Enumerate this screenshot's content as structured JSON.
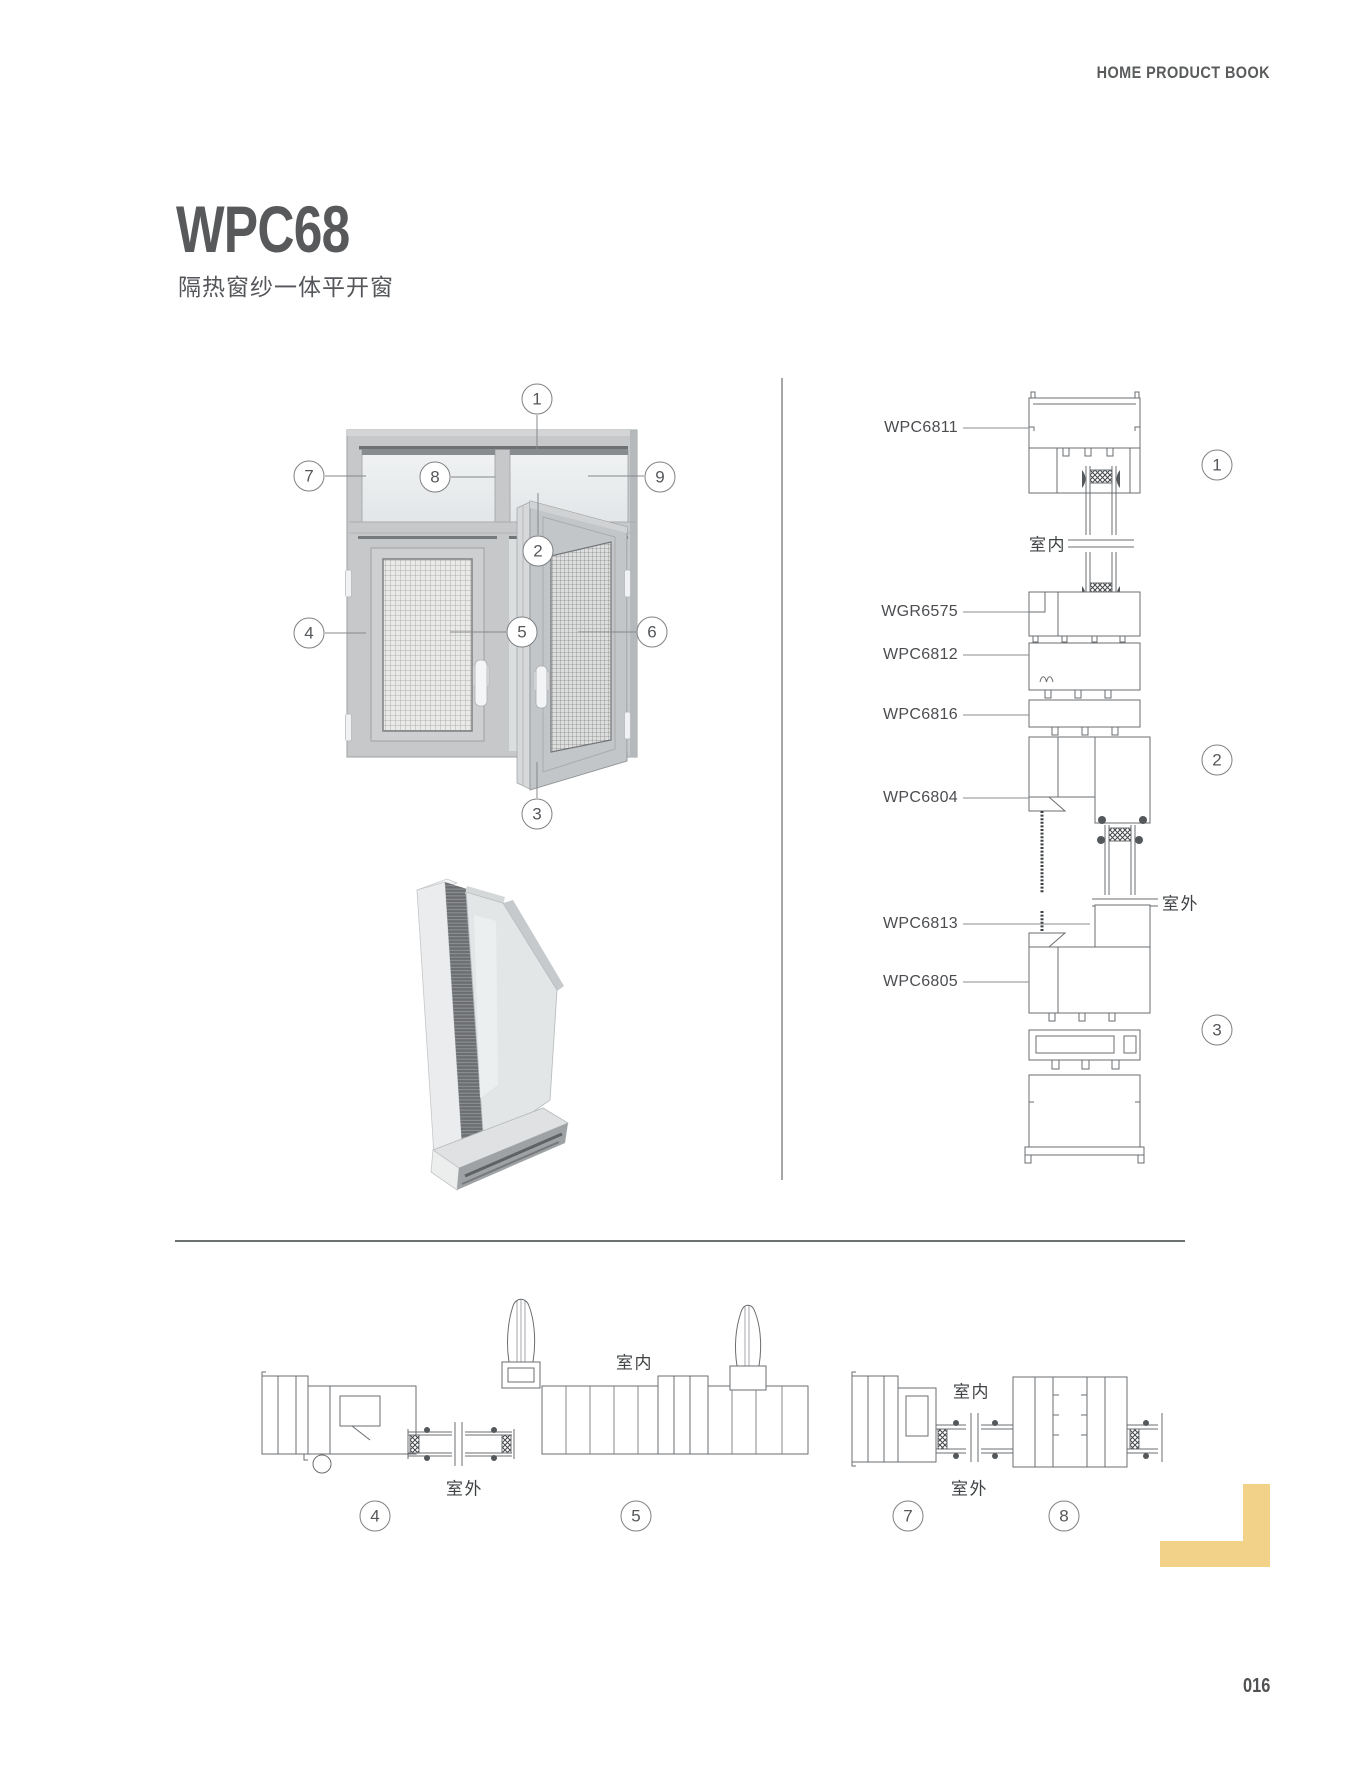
{
  "header": {
    "brand": "HOME PRODUCT BOOK"
  },
  "product": {
    "code": "WPC68",
    "name": "隔热窗纱一体平开窗"
  },
  "sides": {
    "indoor": "室内",
    "outdoor": "室外"
  },
  "callouts": {
    "c1": "1",
    "c2": "2",
    "c3": "3",
    "c4": "4",
    "c5": "5",
    "c6": "6",
    "c7": "7",
    "c8": "8",
    "c9": "9"
  },
  "section_right": {
    "parts": {
      "p1": "WPC6811",
      "p2": "WGR6575",
      "p3": "WPC6812",
      "p4": "WPC6816",
      "p5": "WPC6804",
      "p6": "WPC6813",
      "p7": "WPC6805"
    }
  },
  "footer": {
    "page_number": "016"
  },
  "colors": {
    "accent_yellow": "#F2D189"
  }
}
